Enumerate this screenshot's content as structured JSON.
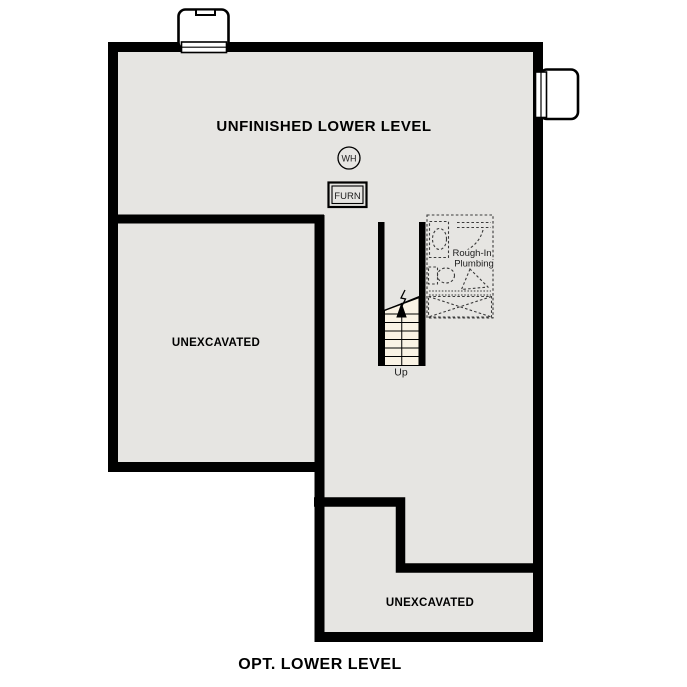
{
  "title": {
    "caption": "OPT. LOWER LEVEL"
  },
  "plan": {
    "main_area_label": "UNFINISHED LOWER LEVEL",
    "water_heater_label": "WH",
    "furnace_label": "FURN",
    "rough_in_label_line1": "Rough-In",
    "rough_in_label_line2": "Plumbing",
    "stairs_direction_label": "Up",
    "unexcavated_left_label": "UNEXCAVATED",
    "unexcavated_bottom_label": "UNEXCAVATED"
  },
  "colors": {
    "wall": "#000000",
    "floor": "#e6e5e2",
    "stair_fill": "#faf3e5",
    "outside": "#ffffff",
    "dashed_detail": "#3a3a3a"
  }
}
